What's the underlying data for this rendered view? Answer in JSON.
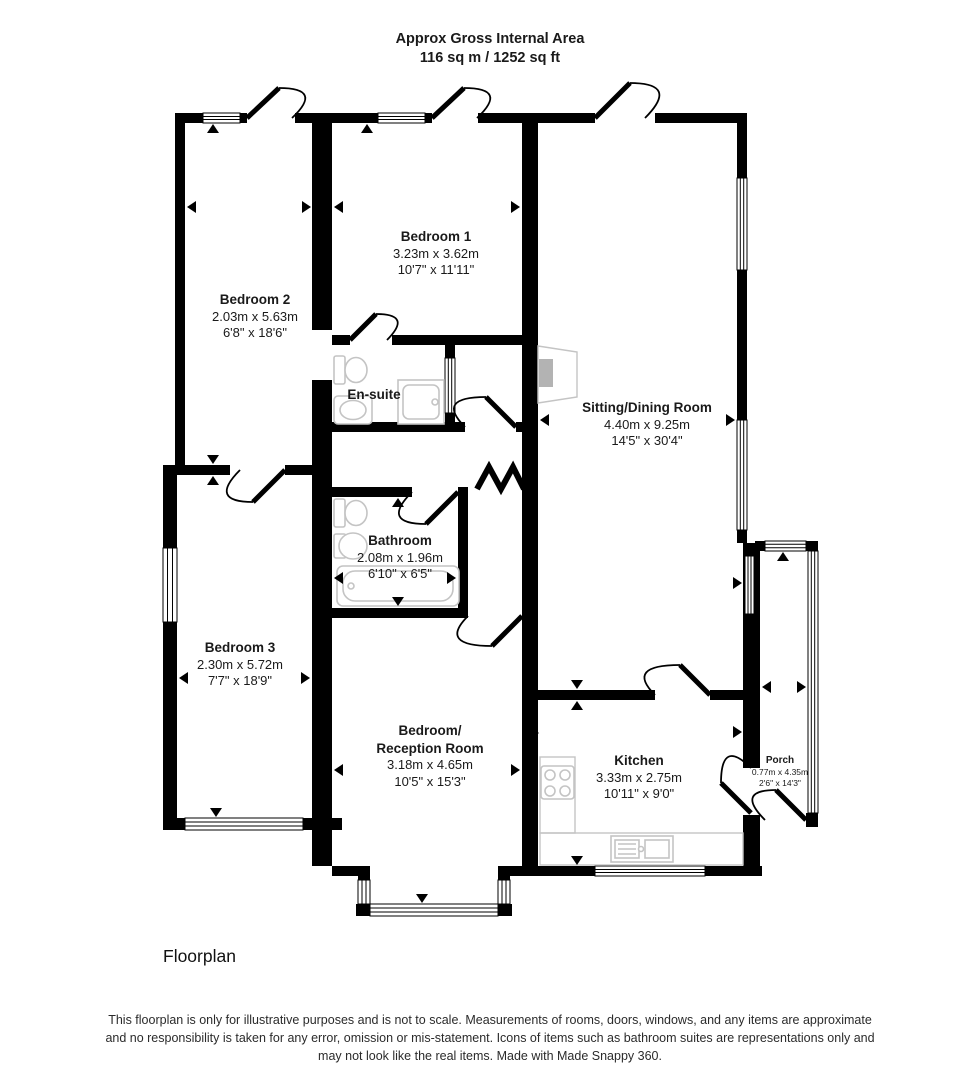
{
  "title": {
    "line1": "Approx Gross Internal Area",
    "line2": "116 sq m / 1252 sq ft"
  },
  "rooms": {
    "bedroom1": {
      "name": "Bedroom 1",
      "metric": "3.23m x 3.62m",
      "imperial": "10'7\" x 11'11\""
    },
    "bedroom2": {
      "name": "Bedroom 2",
      "metric": "2.03m x 5.63m",
      "imperial": "6'8\" x 18'6\""
    },
    "ensuite": {
      "name": "En-suite"
    },
    "sitting": {
      "name": "Sitting/Dining Room",
      "metric": "4.40m x 9.25m",
      "imperial": "14'5\" x 30'4\""
    },
    "bathroom": {
      "name": "Bathroom",
      "metric": "2.08m x 1.96m",
      "imperial": "6'10\" x 6'5\""
    },
    "bedroom3": {
      "name": "Bedroom 3",
      "metric": "2.30m x 5.72m",
      "imperial": "7'7\" x 18'9\""
    },
    "reception": {
      "name_line1": "Bedroom/",
      "name_line2": "Reception Room",
      "metric": "3.18m x 4.65m",
      "imperial": "10'5\" x 15'3\""
    },
    "kitchen": {
      "name": "Kitchen",
      "metric": "3.33m x 2.75m",
      "imperial": "10'11\" x 9'0\""
    },
    "porch": {
      "name": "Porch",
      "metric": "0.77m x 4.35m",
      "imperial": "2'6\" x 14'3\""
    }
  },
  "caption": "Floorplan",
  "disclaimer": "This floorplan is only for illustrative purposes and is not to scale. Measurements of rooms, doors, windows, and any items are approximate and no responsibility is taken for any error, omission or mis-statement. Icons of items such as bathroom suites are representations only and may not look like the real items. Made with Made Snappy 360.",
  "colors": {
    "wall": "#000000",
    "fixture_outline": "#c4c4c4",
    "fireplace_fill": "#b3b3b3",
    "text": "#1a1a1a",
    "background": "#ffffff"
  },
  "icons": [
    "window",
    "door-arc",
    "toilet-icon",
    "basin-icon",
    "shower-icon",
    "bathtub-icon",
    "hob-icon",
    "kitchen-sink-icon",
    "counter-icon",
    "fireplace-icon",
    "opening-zigzag-icon",
    "measurement-arrow-icon"
  ]
}
